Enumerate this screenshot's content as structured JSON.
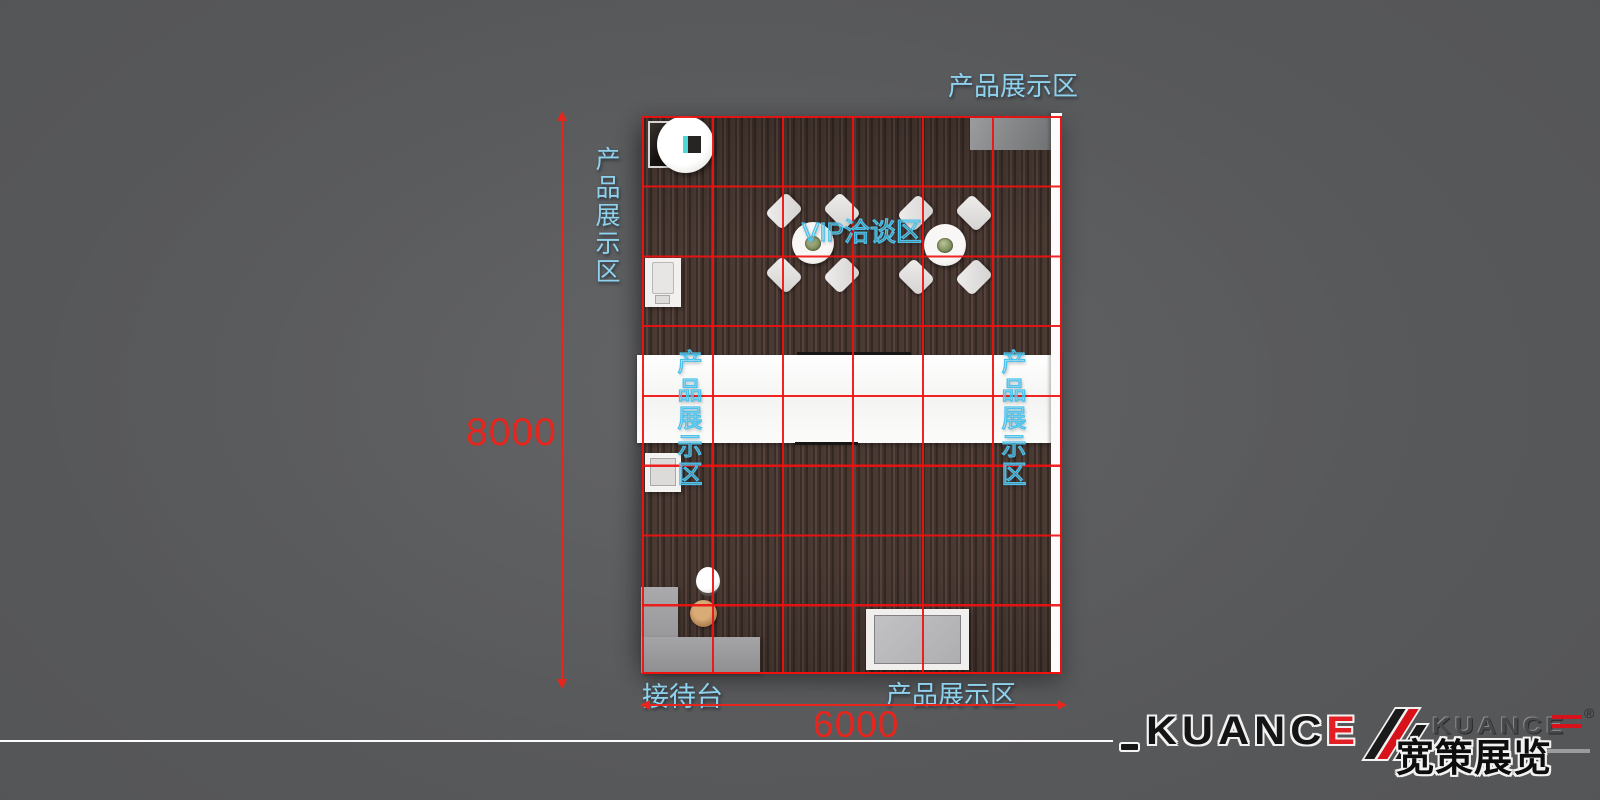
{
  "plan": {
    "labels": {
      "top_display": "产品展示区",
      "left_display": "产品展示区",
      "vip": "VIP洽谈区",
      "mid_left_display": "产品展示区",
      "mid_right_display": "产品展示区",
      "reception": "接待台",
      "bottom_display": "产品展示区"
    },
    "dimensions": {
      "height_mm": "8000",
      "width_mm": "6000"
    },
    "grid": {
      "columns": 6,
      "rows": 8,
      "line_color": "#f01010"
    },
    "colors": {
      "background": "#555658",
      "floor_wood": "#44342e",
      "label_cyan": "#8fd2ee",
      "dimension_red": "#e8251d",
      "counter_white": "#f7f7f6",
      "desk_gray": "#9c9c9e"
    }
  },
  "logo": {
    "dash": "-",
    "brand_main": "KUANC",
    "brand_e": "E",
    "brand_small": "KUANCE",
    "brand_cn": "宽策展览",
    "reg": "®",
    "accent_red": "#d8121a"
  }
}
